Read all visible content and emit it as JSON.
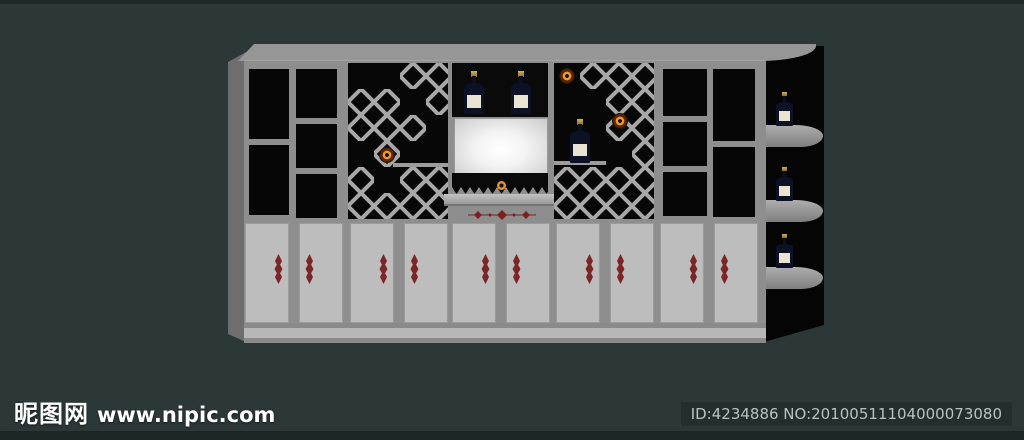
{
  "watermark": {
    "site_name": "昵图网",
    "site_url": "www.nipic.com"
  },
  "image_info": {
    "id_text": "ID:4234886 NO:20100511104000073080"
  },
  "scene": {
    "subject": "wine display cabinet 3D render",
    "counts": {
      "wine_bottles": 6,
      "decor_plates": 3,
      "door_pairs": 5,
      "open_niches": 10
    },
    "colors": {
      "background": "#2c3737",
      "edge_strip": "#1e2929",
      "badge_bg": "#232e2e",
      "badge_text": "#b8c2c2",
      "watermark_text": "#ffffff",
      "cabinet_frame": "#8e8e8e",
      "cabinet_top": "#969696",
      "cabinet_side": "#6e6e6e",
      "niche_black": "#060606",
      "door_panel": "#bdbdbd",
      "plinth": "#b7b7b7",
      "lattice": "#a8a8a8",
      "screen_white": "#ffffff",
      "bottle_body": "#0d1126",
      "bottle_label": "#e9e5d2",
      "bottle_capsule": "#bfa04c",
      "plate_orange": "#e8912c",
      "ornament_red": "#7d2424",
      "end_unit_black": "#050505"
    }
  }
}
